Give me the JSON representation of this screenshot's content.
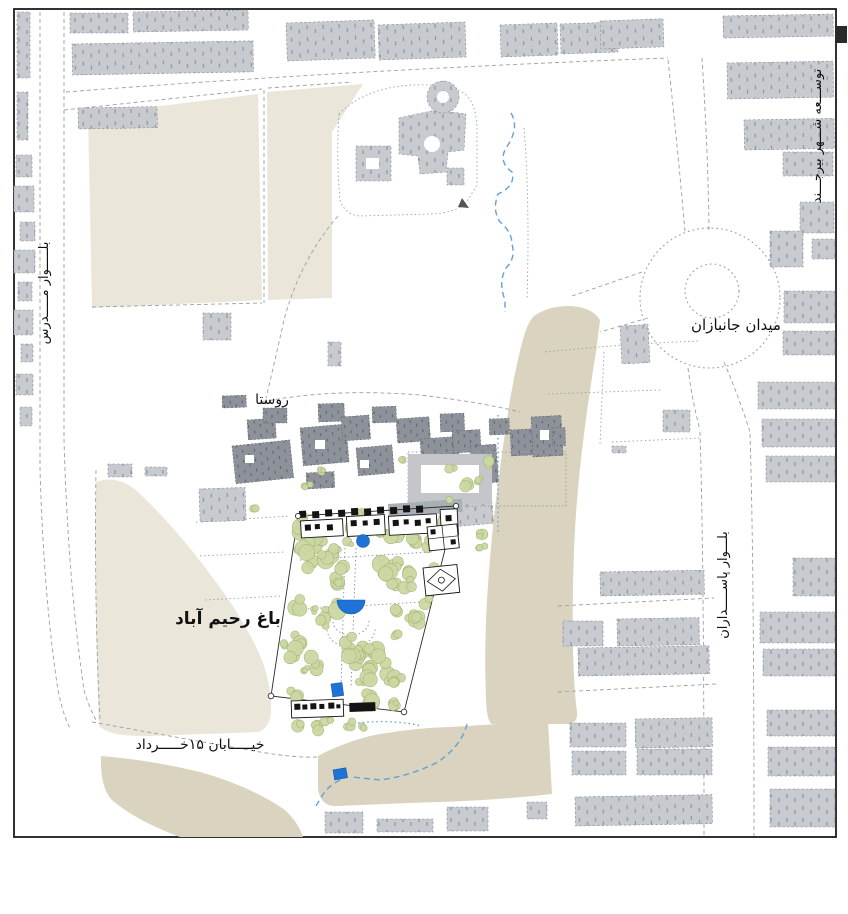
{
  "map": {
    "region_label_top_right": "توســـعه شـــهر بیرجـــند",
    "square_label": "میدان جانبازان",
    "left_boulevard_label": "بلـــــوار مـــــدرس",
    "right_boulevard_label": "بلـــوار پاســـــداران",
    "village_label": "روستا",
    "garden_label": "باغ رحیم آباد",
    "bottom_street_label": "خیـــــابان ۱۵خـــــرداد"
  },
  "colors": {
    "building": "#c7cbd0",
    "building_tick": "#8f959d",
    "village": "#8d929a",
    "village_tick": "#60656c",
    "beige": "#eae6da",
    "khaki": "#d9d3bf",
    "tree": "#ccd8a4",
    "tree_stroke": "#a3b574",
    "water": "#1f72d6",
    "stream": "#64a0d8",
    "frame": "#1c1c1c",
    "road": "#9aa0a6",
    "plan": "#141414",
    "label": "#111111"
  }
}
